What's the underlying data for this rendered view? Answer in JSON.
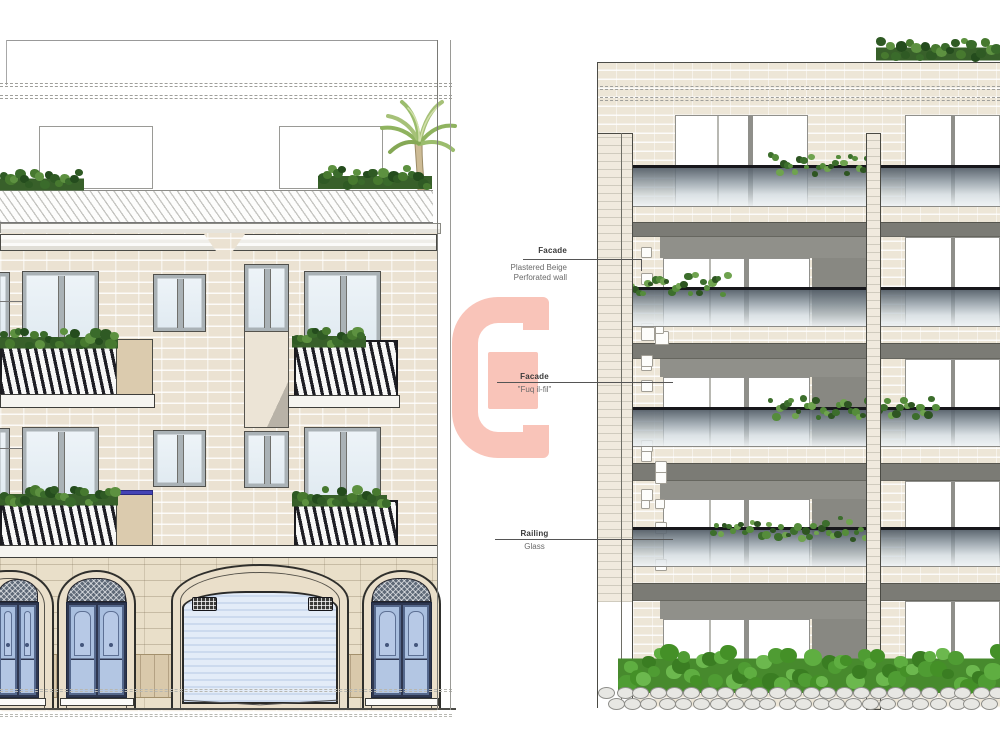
{
  "annotations": [
    {
      "title": "Facade",
      "lines": [
        "Plastered Beige",
        "Perforated wall"
      ]
    },
    {
      "title": "Facade",
      "lines": [
        "\"Fuq il-fil\""
      ]
    },
    {
      "title": "Railing",
      "lines": [
        "Glass"
      ]
    }
  ],
  "watermark": {
    "color": "#f9c4b9"
  },
  "palette": {
    "brick_beige": "#ebe2d2",
    "stone_ashlar": "#e9dfc9",
    "base_tan": "#d9c9ab",
    "door_blue": "#a9bfdf",
    "garage_blue": "#e3ecf8",
    "slab_gray": "#7b7b75",
    "glass_railing": "#8f9ca6",
    "plant_green": "#47792f",
    "hedge_green": "#55a238"
  }
}
